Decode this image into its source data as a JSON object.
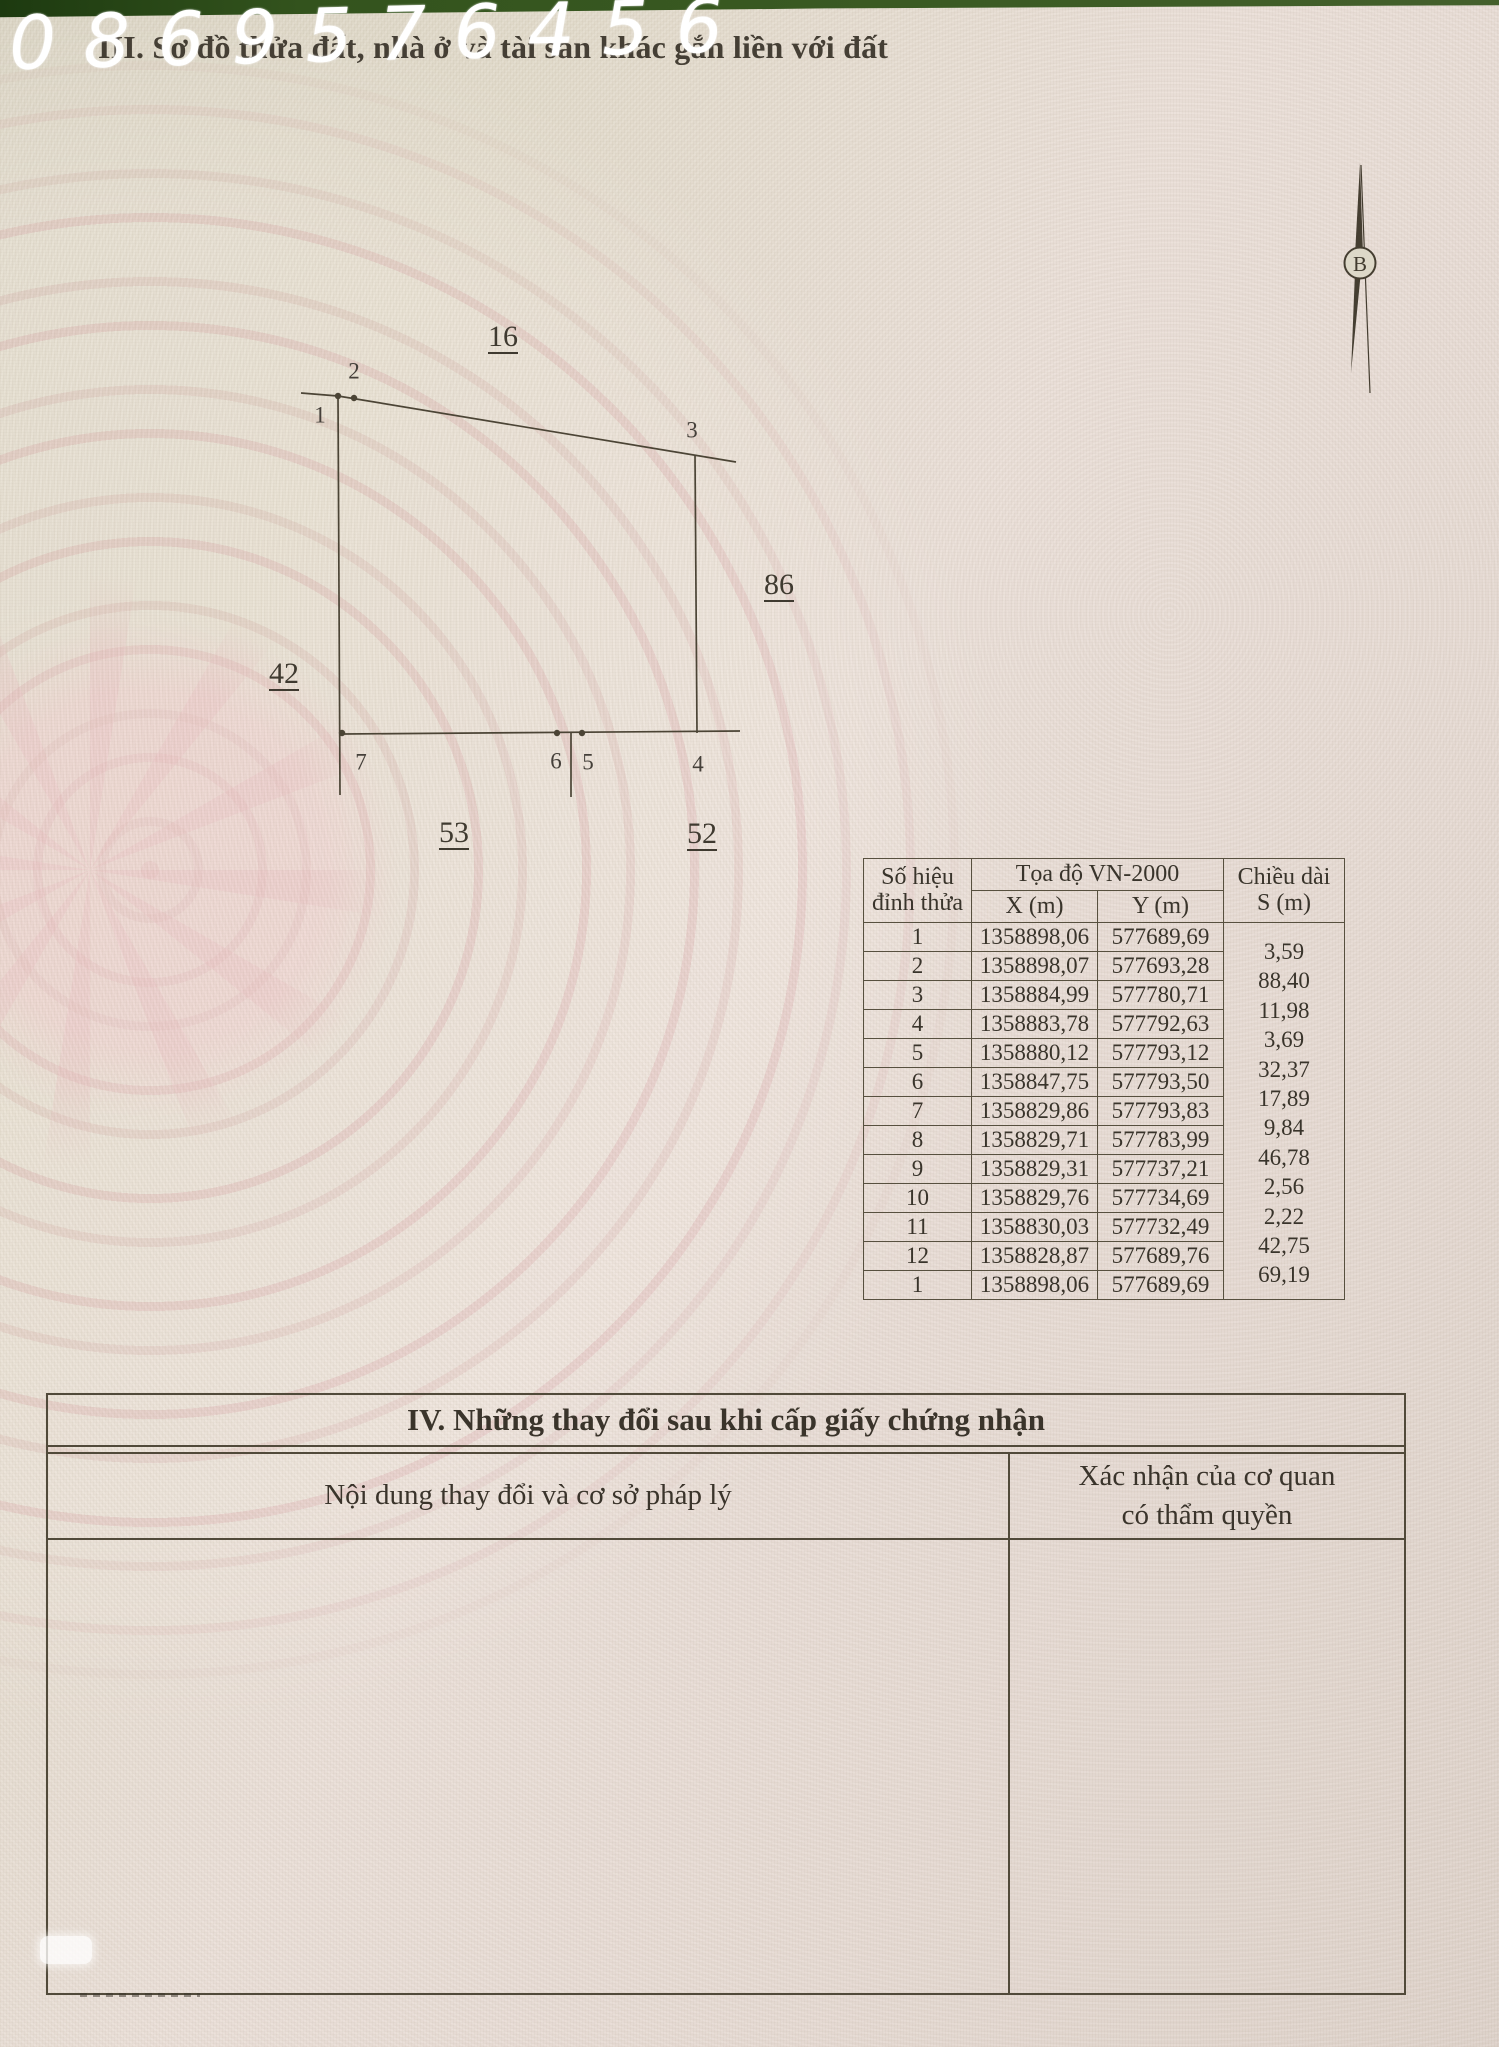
{
  "phone_watermark": "0869576456",
  "page_header": {
    "section_title": "III. Sơ đồ thửa đất, nhà ở và tài sản khác gắn liền với đất"
  },
  "compass": {
    "north_label": "B"
  },
  "parcel_diagram": {
    "vertex_labels": {
      "v1": "1",
      "v2": "2",
      "v3": "3",
      "v4": "4",
      "v5": "5",
      "v6": "6",
      "v7": "7"
    },
    "adjacent_parcels": {
      "north": "16",
      "east": "86",
      "west": "42",
      "south_left": "53",
      "south_right": "52"
    }
  },
  "coordinate_table": {
    "headers": {
      "vertex_line1": "Số hiệu",
      "vertex_line2": "đỉnh thửa",
      "coords": "Tọa độ VN-2000",
      "x": "X (m)",
      "y": "Y (m)",
      "length_line1": "Chiều dài",
      "length_line2": "S (m)"
    },
    "rows": [
      {
        "v": "1",
        "x": "1358898,06",
        "y": "577689,69"
      },
      {
        "v": "2",
        "x": "1358898,07",
        "y": "577693,28"
      },
      {
        "v": "3",
        "x": "1358884,99",
        "y": "577780,71"
      },
      {
        "v": "4",
        "x": "1358883,78",
        "y": "577792,63"
      },
      {
        "v": "5",
        "x": "1358880,12",
        "y": "577793,12"
      },
      {
        "v": "6",
        "x": "1358847,75",
        "y": "577793,50"
      },
      {
        "v": "7",
        "x": "1358829,86",
        "y": "577793,83"
      },
      {
        "v": "8",
        "x": "1358829,71",
        "y": "577783,99"
      },
      {
        "v": "9",
        "x": "1358829,31",
        "y": "577737,21"
      },
      {
        "v": "10",
        "x": "1358829,76",
        "y": "577734,69"
      },
      {
        "v": "11",
        "x": "1358830,03",
        "y": "577732,49"
      },
      {
        "v": "12",
        "x": "1358828,87",
        "y": "577689,76"
      },
      {
        "v": "1",
        "x": "1358898,06",
        "y": "577689,69"
      }
    ],
    "edge_lengths": [
      "3,59",
      "88,40",
      "11,98",
      "3,69",
      "32,37",
      "17,89",
      "9,84",
      "46,78",
      "2,56",
      "2,22",
      "42,75",
      "69,19"
    ]
  },
  "changes_section": {
    "title": "IV. Những thay đổi sau khi cấp giấy chứng nhận",
    "left_column_header": "Nội dung thay đổi và cơ sở pháp lý",
    "right_column_header_line1": "Xác nhận của cơ quan",
    "right_column_header_line2": "có thẩm quyền"
  },
  "colors": {
    "ink": "#3a342b",
    "table_line": "#57503f",
    "drum_pink": "#e5b4b8",
    "page_beige": "#e2dbcb",
    "green_edge": "#33531d",
    "watermark_white": "#ffffff"
  }
}
